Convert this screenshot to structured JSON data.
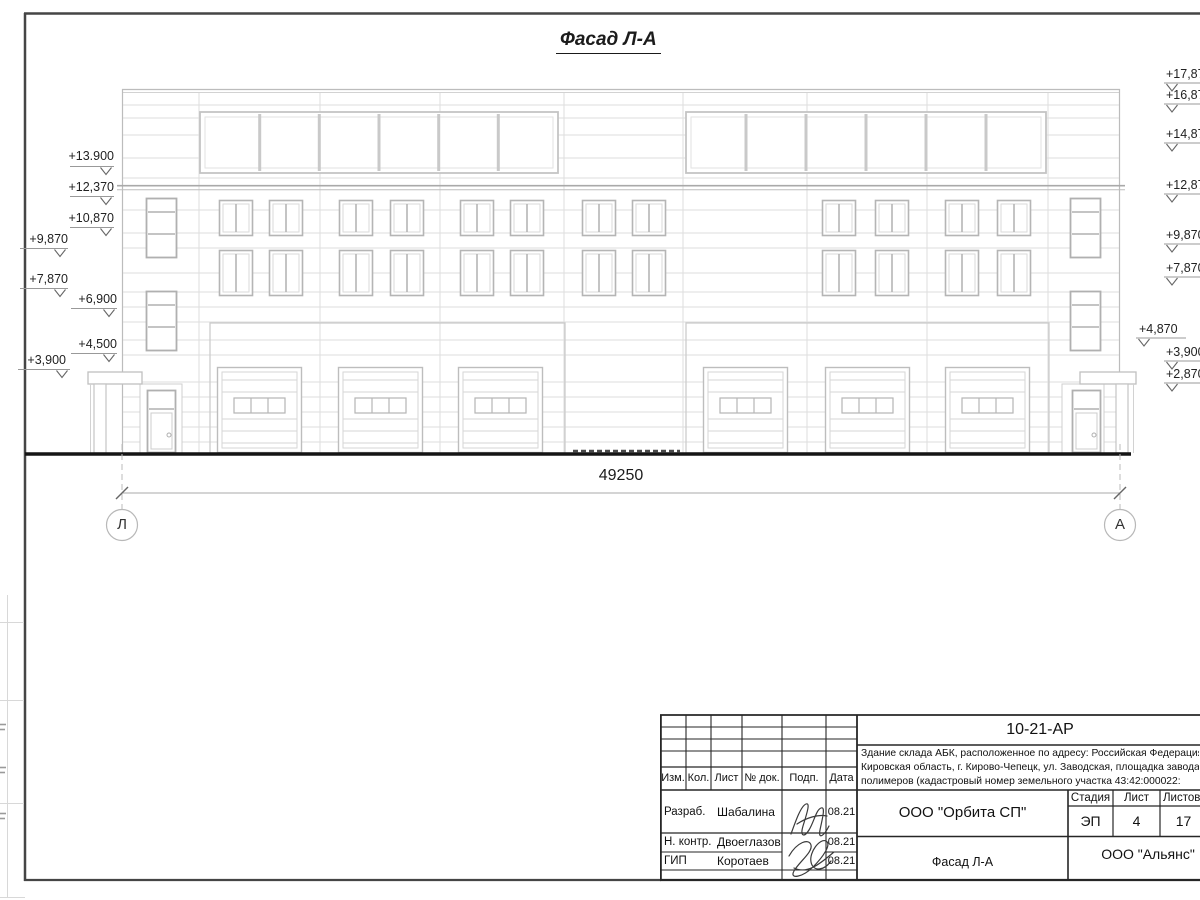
{
  "drawing": {
    "title": "Фасад Л-А",
    "dimension_label": "49250",
    "axis_left": "Л",
    "axis_right": "А",
    "elevations_left": [
      "+13.900",
      "+12,370",
      "+10,870",
      "+9,870",
      "+7,870",
      "+6,900",
      "+4,500",
      "+3,900"
    ],
    "elevations_right": [
      "+17,870",
      "+16,870",
      "+14,870",
      "+12,870",
      "+9,870",
      "+7,870",
      "+4,870",
      "+3,900",
      "+2,870"
    ]
  },
  "titleblock": {
    "doc_number": "10-21-АР",
    "description_lines": [
      "Здание склада АБК, расположенное по адресу: Российская Федерация,",
      "Кировская область, г. Кирово-Чепецк, ул. Заводская, площадка завода",
      "полимеров (кадастровый номер земельного участка 43:42:000022:"
    ],
    "columns": {
      "izm": "Изм.",
      "kol": "Кол.",
      "list": "Лист",
      "ndok": "№ док.",
      "podp": "Подп.",
      "data": "Дата"
    },
    "rows": [
      {
        "role": "Разраб.",
        "name": "Шабалина",
        "date": "08.21"
      },
      {
        "role": "Н. контр.",
        "name": "Двоеглазов",
        "date": "08.21"
      },
      {
        "role": "ГИП",
        "name": "Коротаев",
        "date": "08.21"
      }
    ],
    "company": "ООО \"Орбита СП\"",
    "stage_label": "Стадия",
    "sheet_label": "Лист",
    "sheets_label": "Листов",
    "stage": "ЭП",
    "sheet_number": "4",
    "sheets_total": "17",
    "drawing_name": "Фасад Л-А",
    "contractor": "ООО \"Альянс\""
  }
}
